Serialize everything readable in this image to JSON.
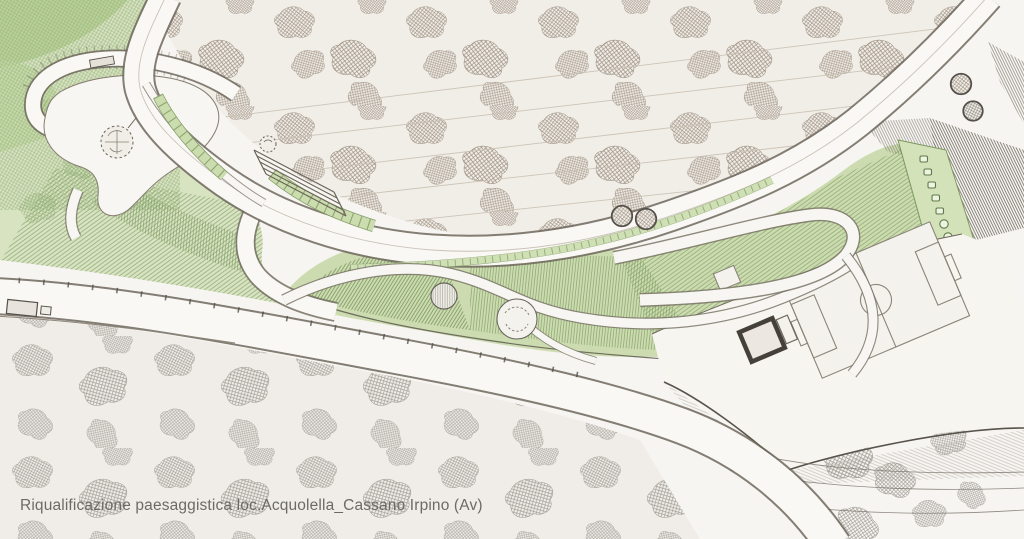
{
  "caption": {
    "text": "Riqualificazione paesaggistica loc.Acquolella_Cassano Irpino (Av)"
  },
  "palette": {
    "paper": "#f7f5f1",
    "caption_color": "#6b6b66",
    "canopy_hatch": "#9a8e80",
    "woodland_hatch": "#8e8a84",
    "park_green_light": "#d8e3c2",
    "park_green": "#ccdcb0",
    "park_green_dark": "#6d8a52",
    "road_fill": "#faf8f5",
    "road_edge": "#6e675d",
    "ink_dark": "#57534b"
  },
  "drawing": {
    "type": "landscape-masterplan-sketch",
    "features": [
      "tree-canopy-hillside",
      "panoramic-road",
      "loop-road-with-parking",
      "belvedere-plaza",
      "labyrinth-circle",
      "central-park-band",
      "circular-plazas",
      "hairpin-promenade",
      "tree-lined-alley",
      "sports-field",
      "farm-building",
      "terraced-slope",
      "lower-road",
      "woodland"
    ]
  }
}
